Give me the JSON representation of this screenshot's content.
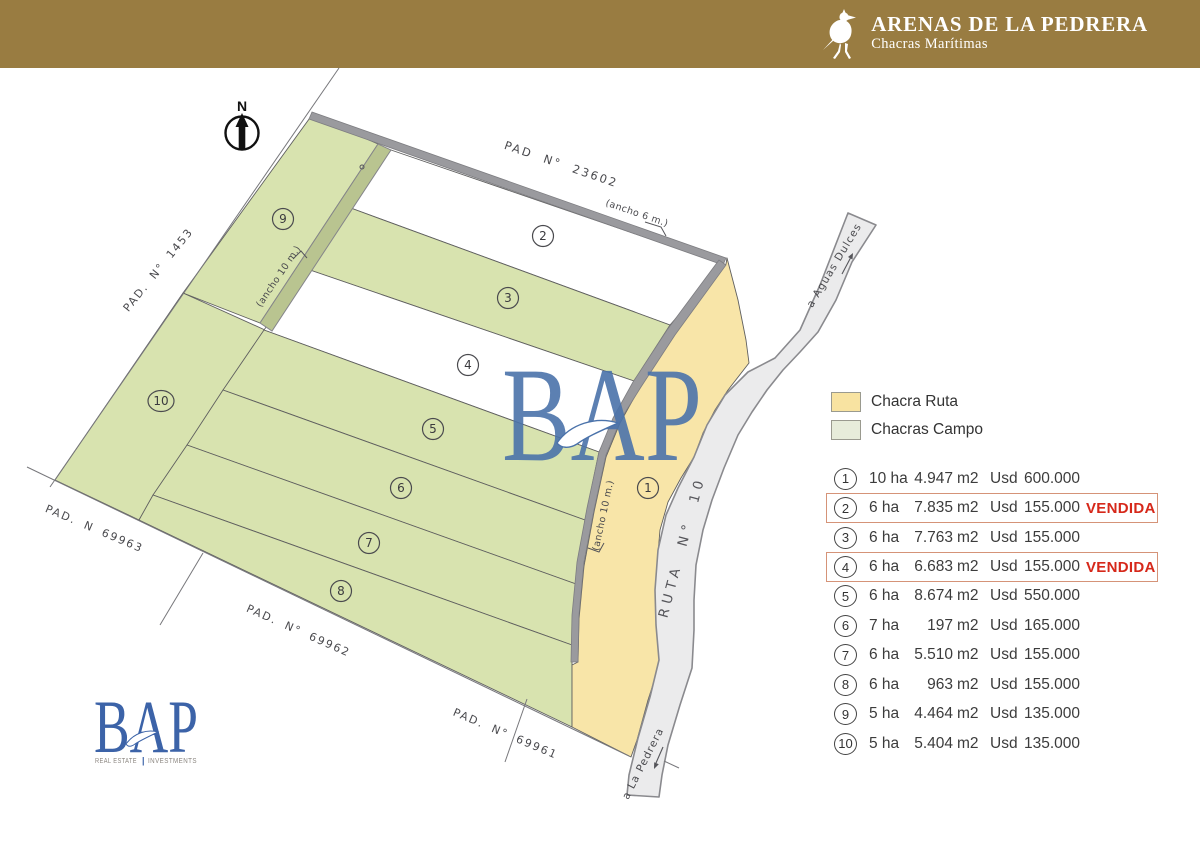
{
  "header": {
    "title": "ARENAS DE LA PEDRERA",
    "subtitle": "Chacras Marítimas"
  },
  "map": {
    "north_label": "N",
    "pads": {
      "top": "PAD N° 23602",
      "left": "PAD. N° 1453",
      "bottom_left": "PAD. N 69963",
      "bottom": "PAD. N° 69962",
      "bottom_right": "PAD. N° 69961"
    },
    "roads": {
      "ruta": "RUTA N° 10",
      "to_aguas_dulces": "a Aguas Dulces",
      "to_la_pedrera": "a La Pedrera"
    },
    "widths": {
      "w6": "(ancho 6 m.)",
      "w10": "(ancho 10 m.)"
    },
    "lot_numbers": [
      "1",
      "2",
      "3",
      "4",
      "5",
      "6",
      "7",
      "8",
      "9",
      "10"
    ]
  },
  "legend": {
    "items": [
      {
        "label": "Chacra Ruta",
        "color": "#f8e3a1"
      },
      {
        "label": "Chacras Campo",
        "color": "#e7ecda"
      }
    ]
  },
  "units": {
    "area": "m2",
    "currency": "Usd"
  },
  "sold_label": "VENDIDA",
  "listings": [
    {
      "num": "1",
      "ha": "10 ha",
      "m2": "4.947",
      "price": "600.000",
      "sold": false
    },
    {
      "num": "2",
      "ha": "6 ha",
      "m2": "7.835",
      "price": "155.000",
      "sold": true
    },
    {
      "num": "3",
      "ha": "6 ha",
      "m2": "7.763",
      "price": "155.000",
      "sold": false
    },
    {
      "num": "4",
      "ha": "6 ha",
      "m2": "6.683",
      "price": "155.000",
      "sold": true
    },
    {
      "num": "5",
      "ha": "6 ha",
      "m2": "8.674",
      "price": "550.000",
      "sold": false
    },
    {
      "num": "6",
      "ha": "7 ha",
      "m2": "197",
      "price": "165.000",
      "sold": false
    },
    {
      "num": "7",
      "ha": "6 ha",
      "m2": "5.510",
      "price": "155.000",
      "sold": false
    },
    {
      "num": "8",
      "ha": "6 ha",
      "m2": "963",
      "price": "155.000",
      "sold": false
    },
    {
      "num": "9",
      "ha": "5 ha",
      "m2": "4.464",
      "price": "135.000",
      "sold": false
    },
    {
      "num": "10",
      "ha": "5 ha",
      "m2": "5.404",
      "price": "135.000",
      "sold": false
    }
  ],
  "logo": {
    "name": "BAP",
    "tagline_left": "REAL ESTATE",
    "tagline_sep": "|",
    "tagline_right": "INVESTMENTS"
  },
  "colors": {
    "header_bg": "#997c41",
    "accent_blue": "#4a72aa",
    "sold_red": "#d6281a",
    "chacra_ruta_fill": "#f8e5a8",
    "chacras_campo_fill": "#d8e3af",
    "route_fill": "#ebebec",
    "road_strip": "#9a9a9e"
  }
}
